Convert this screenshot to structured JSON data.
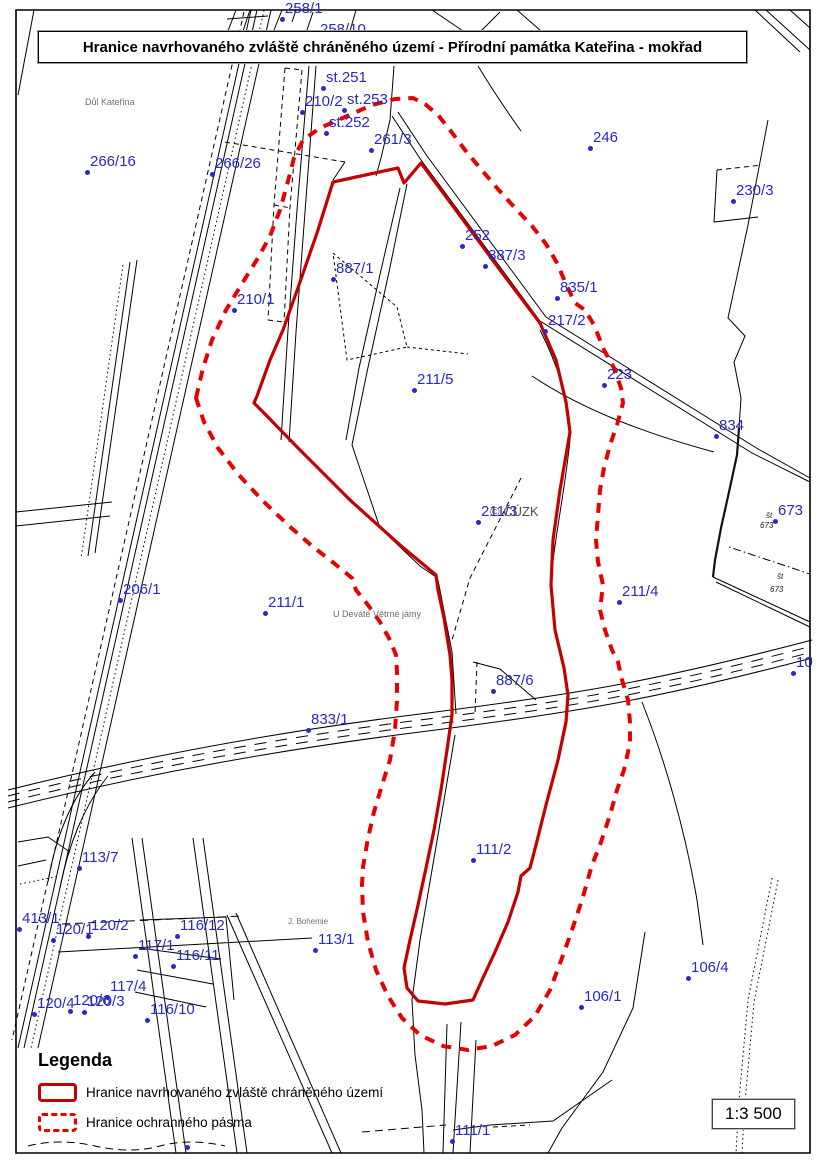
{
  "title": "Hranice navrhovaného zvláště chráněného území - Přírodní památka Kateřina - mokřad",
  "scale": "1:3 500",
  "legend": {
    "heading": "Legenda",
    "items": [
      {
        "style": "solid",
        "label": "Hranice navrhovaného zvláště chráněného území"
      },
      {
        "style": "dashed",
        "label": "Hranice ochranného pásma"
      }
    ]
  },
  "colors": {
    "red_solid": "#c40000",
    "red_dashed": "#e60000",
    "blue": "#2929c4",
    "gray": "#6e6e6e"
  },
  "map": {
    "copyright": "© ČÚZK",
    "parcel_labels": [
      {
        "t": "258/1",
        "x": 282,
        "y": 19
      },
      {
        "t": "258/10",
        "x": 317,
        "y": 40,
        "nd": true
      },
      {
        "t": "st.251",
        "x": 323,
        "y": 88
      },
      {
        "t": "210/2",
        "x": 302,
        "y": 112
      },
      {
        "t": "st.253",
        "x": 344,
        "y": 110
      },
      {
        "t": "st.252",
        "x": 326,
        "y": 133
      },
      {
        "t": "261/3",
        "x": 371,
        "y": 150
      },
      {
        "t": "246",
        "x": 590,
        "y": 148
      },
      {
        "t": "266/16",
        "x": 87,
        "y": 172
      },
      {
        "t": "266/26",
        "x": 212,
        "y": 174
      },
      {
        "t": "230/3",
        "x": 733,
        "y": 201
      },
      {
        "t": "252",
        "x": 462,
        "y": 246
      },
      {
        "t": "887/3",
        "x": 485,
        "y": 266
      },
      {
        "t": "887/1",
        "x": 333,
        "y": 279
      },
      {
        "t": "835/1",
        "x": 557,
        "y": 298
      },
      {
        "t": "210/1",
        "x": 234,
        "y": 310
      },
      {
        "t": "217/2",
        "x": 545,
        "y": 331
      },
      {
        "t": "223",
        "x": 604,
        "y": 385
      },
      {
        "t": "211/5",
        "x": 414,
        "y": 390
      },
      {
        "t": "834",
        "x": 716,
        "y": 436
      },
      {
        "t": "211/3",
        "x": 478,
        "y": 522
      },
      {
        "t": "673",
        "x": 775,
        "y": 521
      },
      {
        "t": "206/1",
        "x": 120,
        "y": 600
      },
      {
        "t": "211/1",
        "x": 265,
        "y": 613
      },
      {
        "t": "211/4",
        "x": 619,
        "y": 602
      },
      {
        "t": "887/6",
        "x": 493,
        "y": 691
      },
      {
        "t": "833/1",
        "x": 308,
        "y": 730
      },
      {
        "t": "111/2",
        "x": 473,
        "y": 860
      },
      {
        "t": "113/7",
        "x": 79,
        "y": 868
      },
      {
        "t": "413/1",
        "x": 19,
        "y": 929
      },
      {
        "t": "120/1",
        "x": 53,
        "y": 940
      },
      {
        "t": "120/2",
        "x": 88,
        "y": 936
      },
      {
        "t": "116/12",
        "x": 177,
        "y": 936
      },
      {
        "t": "113/1",
        "x": 315,
        "y": 950
      },
      {
        "t": "117/1",
        "x": 135,
        "y": 956
      },
      {
        "t": "116/11",
        "x": 173,
        "y": 966
      },
      {
        "t": "117/4",
        "x": 107,
        "y": 997
      },
      {
        "t": "120/4",
        "x": 34,
        "y": 1014
      },
      {
        "t": "120/6",
        "x": 70,
        "y": 1011
      },
      {
        "t": "120/3",
        "x": 84,
        "y": 1012
      },
      {
        "t": "116/10",
        "x": 147,
        "y": 1020
      },
      {
        "t": "106/4",
        "x": 688,
        "y": 978
      },
      {
        "t": "106/1",
        "x": 581,
        "y": 1007
      },
      {
        "t": "111/1",
        "x": 452,
        "y": 1141
      },
      {
        "t": "10",
        "x": 793,
        "y": 673
      },
      {
        "t": "",
        "x": 187,
        "y": 1147
      }
    ],
    "place_labels": [
      {
        "t": "Důl Kateřina",
        "x": 85,
        "y": 97,
        "size": 9
      },
      {
        "t": "U Deváté Větrné jámy",
        "x": 333,
        "y": 609,
        "size": 9
      },
      {
        "t": "J. Bohemie",
        "x": 288,
        "y": 917,
        "size": 8
      },
      {
        "t": "© ČÚZK",
        "x": 490,
        "y": 504,
        "size": 13
      }
    ],
    "annotations": [
      {
        "t": "št",
        "x": 766,
        "y": 511
      },
      {
        "t": "673",
        "x": 760,
        "y": 521
      },
      {
        "t": "št",
        "x": 777,
        "y": 572
      },
      {
        "t": "673",
        "x": 770,
        "y": 585
      }
    ]
  }
}
